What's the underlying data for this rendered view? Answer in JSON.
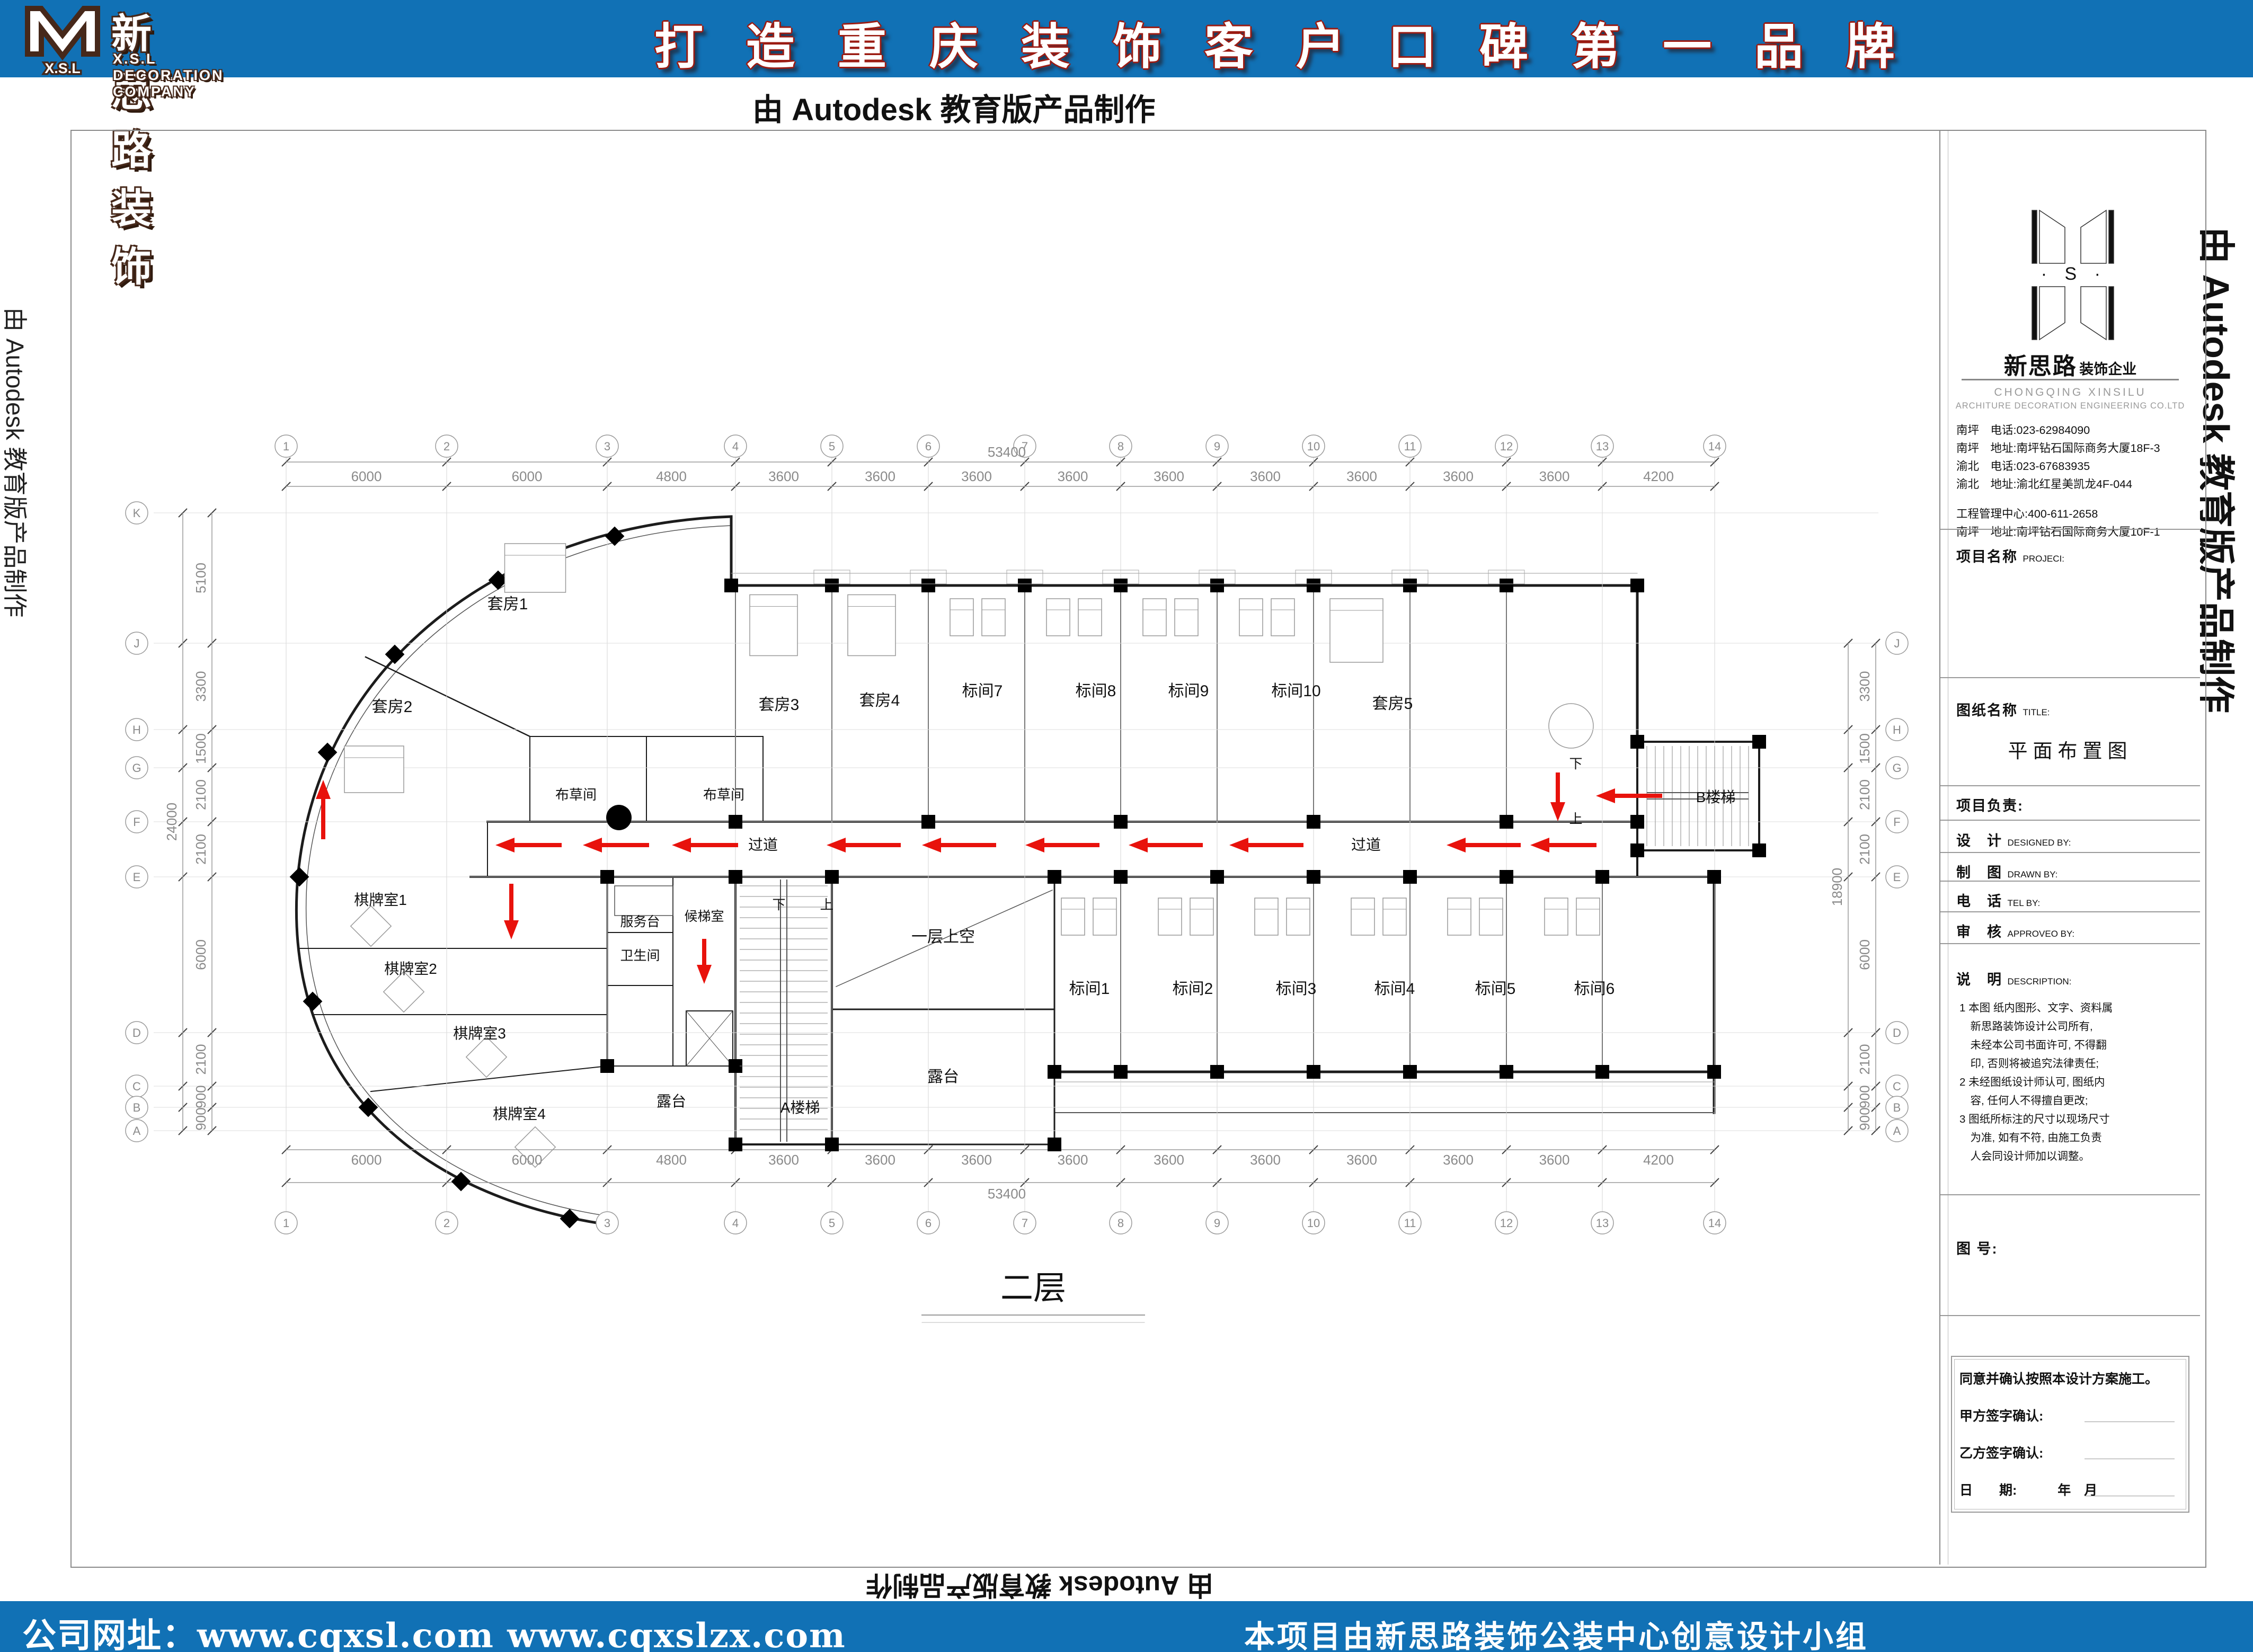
{
  "colors": {
    "brand_blue": "#1171b5",
    "logo_brown": "#46281a",
    "slogan_red": "#9b1b12",
    "arrow_red": "#e8120c"
  },
  "header": {
    "logo_mark_letters": "X.S.L",
    "company_cn": "新思路装饰",
    "company_en": "X.S.L DECORATION COMPANY",
    "slogan": "打造重庆装饰客户口碑第一品牌"
  },
  "watermarks": {
    "top": "由 Autodesk 教育版产品制作",
    "left": "由 Autodesk 教育版产品制作",
    "right": "由 Autodesk 教育版产品制作",
    "bottom": "由 Autodesk 教育版产品制作"
  },
  "footer": {
    "website": "公司网址：www.cqxsl.com  www.cqxslzx.com",
    "credit": "本项目由新思路装饰公装中心创意设计小组"
  },
  "titleblock": {
    "logo_letters": "X · S · L",
    "brand_cn": "新思路",
    "brand_suffix": "装饰企业",
    "brand_en1": "CHONGQING  XINSILU",
    "brand_en2": "ARCHITURE  DECORATION  ENGINEERING  CO.LTD",
    "contacts": [
      "南坪　电话:023-62984090",
      "南坪　地址:南坪钻石国际商务大厦18F-3",
      "渝北　电话:023-67683935",
      "渝北　地址:渝北红星美凯龙4F-044",
      "工程管理中心:400-611-2658",
      "南坪　地址:南坪钻石国际商务大厦10F-1"
    ],
    "project_label": "项目名称",
    "project_en": "PROJECI:",
    "title_label": "图纸名称",
    "title_en": "TITLE:",
    "drawing_title": "平面布置图",
    "pm_label": "项目负责:",
    "design_label": "设　计",
    "design_en": "DESIGNED BY:",
    "draw_label": "制　图",
    "draw_en": "DRAWN BY:",
    "tel_label": "电　话",
    "tel_en": "TEL BY:",
    "approve_label": "审　核",
    "approve_en": "APPROVEO BY:",
    "desc_label": "说　明",
    "desc_en": "DESCRIPTION:",
    "description": [
      "1 本图 纸内图形、文字、资料属",
      "　新思路装饰设计公司所有,",
      "　未经本公司书面许可, 不得翻",
      "　印, 否则将被追究法律责任;",
      "2 未经图纸设计师认可, 图纸内",
      "　容, 任何人不得擅自更改;",
      "3 图纸所标注的尺寸以现场尺寸",
      "　为准, 如有不符, 由施工负责",
      "　人会同设计师加以调整。"
    ],
    "fig_no_label": "图 号:",
    "sign_box": {
      "line1": "同意并确认按照本设计方案施工。",
      "party_a": "甲方签字确认:",
      "party_b": "乙方签字确认:",
      "date_label": "日　　期:",
      "date_suffix": "年　月"
    }
  },
  "plan": {
    "floor_label": "二层",
    "grid_cols": {
      "total": "53400",
      "labels": [
        "1",
        "2",
        "3",
        "4",
        "5",
        "6",
        "7",
        "8",
        "9",
        "10",
        "11",
        "12",
        "13",
        "14"
      ],
      "x": [
        540,
        843,
        1146,
        1388,
        1570,
        1752,
        1934,
        2115,
        2297,
        2479,
        2661,
        2843,
        3024,
        3236
      ],
      "dims": [
        "6000",
        "6000",
        "4800",
        "3600",
        "3600",
        "3600",
        "3600",
        "3600",
        "3600",
        "3600",
        "3600",
        "3600",
        "4200"
      ]
    },
    "rows_left": {
      "total": "24000",
      "labels": [
        "K",
        "J",
        "H",
        "G",
        "F",
        "E",
        "D",
        "C",
        "B",
        "A"
      ],
      "y": [
        968,
        1214,
        1377,
        1449,
        1551,
        1655,
        1949,
        2050,
        2090,
        2134
      ],
      "dims": [
        "5100",
        "3300",
        "1500",
        "2100",
        "2100",
        "6000",
        "2100",
        "900",
        "900"
      ]
    },
    "rows_right": {
      "total": "18900",
      "labels": [
        "J",
        "H",
        "G",
        "F",
        "E",
        "D",
        "C",
        "B",
        "A"
      ],
      "y": [
        1214,
        1377,
        1449,
        1551,
        1655,
        1949,
        2050,
        2090,
        2134
      ],
      "dims": [
        "3300",
        "1500",
        "2100",
        "2100",
        "6000",
        "2100",
        "900",
        "900"
      ]
    },
    "labels": [
      [
        "套房1",
        958,
        1150
      ],
      [
        "套房2",
        740,
        1344
      ],
      [
        "套房3",
        1470,
        1340
      ],
      [
        "套房4",
        1660,
        1332
      ],
      [
        "标间7",
        1854,
        1314
      ],
      [
        "标间8",
        2068,
        1314
      ],
      [
        "标间9",
        2243,
        1314
      ],
      [
        "标间10",
        2446,
        1314
      ],
      [
        "套房5",
        2628,
        1338
      ],
      [
        "布草间",
        1087,
        1509,
        26
      ],
      [
        "布草间",
        1366,
        1509,
        26
      ],
      [
        "过道",
        1440,
        1604,
        28
      ],
      [
        "过道",
        2578,
        1604,
        28
      ],
      [
        "棋牌室1",
        718,
        1708,
        28
      ],
      [
        "棋牌室2",
        775,
        1838,
        28
      ],
      [
        "棋牌室3",
        905,
        1960,
        28
      ],
      [
        "棋牌室4",
        980,
        2112,
        28
      ],
      [
        "服务台",
        1208,
        1748,
        25
      ],
      [
        "卫生间",
        1208,
        1812,
        25
      ],
      [
        "候梯室",
        1329,
        1738,
        25
      ],
      [
        "露台",
        1267,
        2088,
        28
      ],
      [
        "A楼梯",
        1510,
        2100,
        28
      ],
      [
        "一层上空",
        1780,
        1778,
        30
      ],
      [
        "露台",
        1780,
        2042,
        30
      ],
      [
        "标间1",
        2056,
        1876
      ],
      [
        "标间2",
        2251,
        1876
      ],
      [
        "标间3",
        2446,
        1876
      ],
      [
        "标间4",
        2632,
        1876
      ],
      [
        "标间5",
        2822,
        1876
      ],
      [
        "标间6",
        3009,
        1876
      ],
      [
        "B楼梯",
        3238,
        1514,
        28
      ],
      [
        "下",
        1470,
        1716,
        25
      ],
      [
        "上",
        1560,
        1716,
        25
      ],
      [
        "下",
        2974,
        1450,
        25
      ],
      [
        "上",
        2974,
        1554,
        25
      ],
      [
        "二层",
        1950,
        2452,
        62
      ]
    ],
    "arrows": [
      [
        "L",
        935,
        1595,
        95
      ],
      [
        "L",
        1100,
        1595,
        95
      ],
      [
        "L",
        1268,
        1595,
        95
      ],
      [
        "L",
        1560,
        1595,
        110
      ],
      [
        "L",
        1740,
        1595,
        110
      ],
      [
        "L",
        1935,
        1595,
        110
      ],
      [
        "L",
        2130,
        1595,
        110
      ],
      [
        "L",
        2320,
        1595,
        110
      ],
      [
        "L",
        2730,
        1595,
        110
      ],
      [
        "L",
        2888,
        1595,
        95
      ],
      [
        "L",
        3012,
        1502,
        95
      ],
      [
        "D",
        965,
        1668,
        105
      ],
      [
        "D",
        1329,
        1772,
        85
      ],
      [
        "D",
        2940,
        1458,
        92
      ],
      [
        "U",
        610,
        1472,
        82
      ]
    ],
    "columns": [
      [
        1380,
        1105
      ],
      [
        1570,
        1105
      ],
      [
        1752,
        1105
      ],
      [
        1934,
        1105
      ],
      [
        2115,
        1105
      ],
      [
        2297,
        1105
      ],
      [
        2479,
        1105
      ],
      [
        2661,
        1105
      ],
      [
        2843,
        1105
      ],
      [
        3090,
        1105
      ],
      [
        1388,
        1551
      ],
      [
        1752,
        1551
      ],
      [
        2115,
        1551
      ],
      [
        2479,
        1551
      ],
      [
        2843,
        1551
      ],
      [
        3090,
        1551
      ],
      [
        1146,
        1655
      ],
      [
        1388,
        1655
      ],
      [
        1570,
        1655
      ],
      [
        1990,
        1655
      ],
      [
        2115,
        1655
      ],
      [
        2297,
        1655
      ],
      [
        2479,
        1655
      ],
      [
        2661,
        1655
      ],
      [
        2843,
        1655
      ],
      [
        3024,
        1655
      ],
      [
        3235,
        1655
      ],
      [
        1990,
        2023
      ],
      [
        2115,
        2023
      ],
      [
        2297,
        2023
      ],
      [
        2479,
        2023
      ],
      [
        2661,
        2023
      ],
      [
        2843,
        2023
      ],
      [
        3024,
        2023
      ],
      [
        3235,
        2023
      ],
      [
        1388,
        2160
      ],
      [
        1570,
        2160
      ],
      [
        1990,
        2160
      ],
      [
        3090,
        1400
      ],
      [
        3320,
        1400
      ],
      [
        3090,
        1605
      ],
      [
        3320,
        1605
      ],
      [
        1146,
        2012
      ],
      [
        1388,
        2012
      ],
      [
        1160,
        1012,
        1
      ],
      [
        940,
        1095,
        1
      ],
      [
        745,
        1235,
        1
      ],
      [
        618,
        1420,
        1
      ],
      [
        565,
        1655,
        1
      ],
      [
        590,
        1890,
        1
      ],
      [
        695,
        2090,
        1
      ],
      [
        870,
        2230,
        1
      ],
      [
        1075,
        2300,
        1
      ]
    ],
    "dot": [
      1168,
      1543
    ],
    "beds": [
      [
        1815,
        1165
      ],
      [
        1875,
        1165
      ],
      [
        1997,
        1165
      ],
      [
        2057,
        1165
      ],
      [
        2179,
        1165
      ],
      [
        2239,
        1165
      ],
      [
        2361,
        1165
      ],
      [
        2421,
        1165
      ],
      [
        2025,
        1730
      ],
      [
        2085,
        1730
      ],
      [
        2208,
        1730
      ],
      [
        2268,
        1730
      ],
      [
        2390,
        1730
      ],
      [
        2450,
        1730
      ],
      [
        2572,
        1730
      ],
      [
        2632,
        1730
      ],
      [
        2754,
        1730
      ],
      [
        2814,
        1730
      ],
      [
        2937,
        1730
      ],
      [
        2997,
        1730
      ]
    ],
    "suites": [
      [
        1460,
        1180,
        90,
        115
      ],
      [
        1645,
        1180,
        90,
        115
      ],
      [
        2560,
        1190,
        100,
        120
      ],
      [
        1010,
        1072,
        115,
        92
      ],
      [
        706,
        1452,
        112,
        88
      ]
    ],
    "tables": [
      [
        700,
        1748
      ],
      [
        762,
        1872
      ],
      [
        918,
        1995
      ],
      [
        1010,
        2165
      ]
    ]
  }
}
